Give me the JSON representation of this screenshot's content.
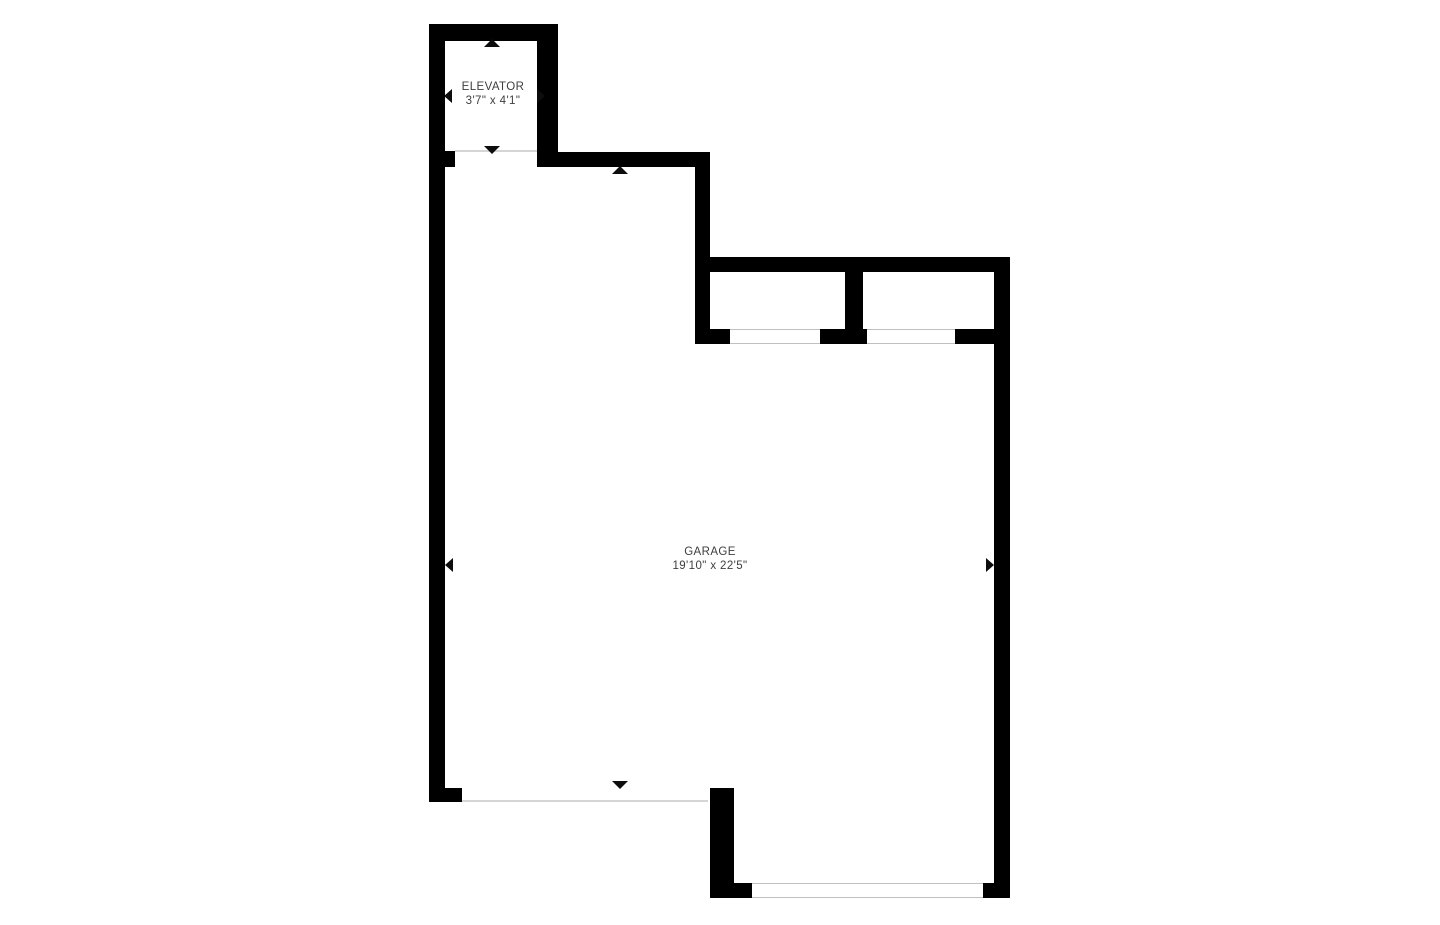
{
  "rooms": {
    "elevator": {
      "name": "ELEVATOR",
      "dims": "3'7\" x 4'1\""
    },
    "garage": {
      "name": "GARAGE",
      "dims": "19'10\" x 22'5\""
    }
  },
  "colors": {
    "background": "#ffffff",
    "wall": "#000000",
    "opening_line": "#d5d5d5",
    "window_border": "#c0c0c0",
    "label_text": "#3e3e3e",
    "marker": "#0d0d0d"
  }
}
